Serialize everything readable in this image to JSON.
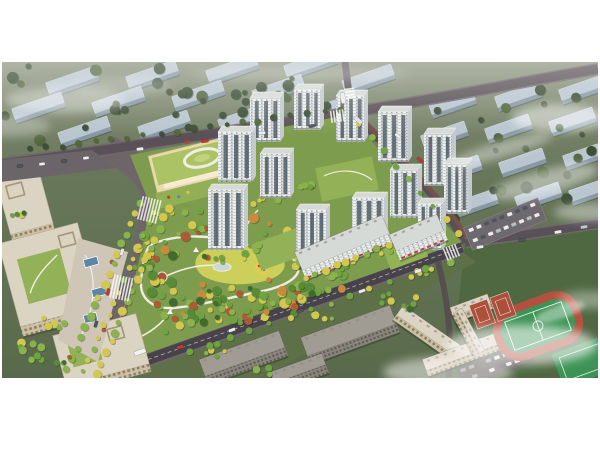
{
  "meta": {
    "type": "architectural-aerial-rendering",
    "description": "Bird's-eye rendering of a residential masterplan: white high-rise towers around a large landscaped central park, a kindergarten with a light-green roof and oval rooftop track, beige office blocks on a tree-lined boulevard to the west, ground-floor retail slabs with red awnings along the south street, a school campus with red basketball courts and a green running-track field to the south-east, and hazy rows of blue-grey apartment slabs with drifting mist in the background. No text appears in the image.",
    "canvas": {
      "width": 600,
      "height": 450
    },
    "frame_color": "#ffffff"
  },
  "palette": {
    "frame": "#ffffff",
    "hazeTop": "#8a927c",
    "bgMid": "#68775a",
    "bgDark": "#596a4b",
    "woodDark": "#4f6842",
    "southGreen": "#5d7048",
    "bgTree1": "#3d4f35",
    "bgTree2": "#54673f",
    "slabTop": "#b9c6d0",
    "slabSide": "#8798a4",
    "road": "#595157",
    "roadCasing": "#6f676b",
    "roadDark": "#48434a",
    "avenue": "#6f6569",
    "sidewalkRed": "#7c5148",
    "pavement": "#cfc6b8",
    "siteGround": "#7e9c4d",
    "courtyard": "#93b156",
    "lawn": "#ccd05a",
    "path": "#efece1",
    "parkG1": "#3f6b2e",
    "parkG2": "#578b38",
    "parkG3": "#6fa341",
    "parkG4": "#8ab24d",
    "autumnY": "#d3c84f",
    "autumnO": "#c98a3e",
    "autumnR": "#ad5a35",
    "towerFace": "#edefee",
    "towerSide": "#c3c9cc",
    "towerRoof": "#d6dad6",
    "towerWin": "#46525c",
    "floorLine": "#9aa1a6",
    "awning": "#b2483c",
    "grayFace": "#8a867d",
    "grayRoof": "#a09c93",
    "grayWin": "#4e4a45",
    "beigeFace": "#cdbfa2",
    "beigeShade": "#a59577",
    "beigeRoof": "#dcd4c2",
    "beigeWin": "#6e6355",
    "kgRoof": "#abc364",
    "kgWall": "#e8dba9",
    "fieldGreen": "#3d9355",
    "trackRed": "#b2513f",
    "courtRed": "#ae4f3c",
    "canopyBlue": "#5c86a8",
    "water": "#c7d9d2",
    "flowerBed": "#a9553e",
    "playYellow": "#e2cb53",
    "carWhite": "#ececec",
    "carDark": "#4e555c",
    "carRed": "#c03b30",
    "mist": "#ffffff"
  },
  "scene": {
    "regions": [
      {
        "name": "background-city-left",
        "desc": "hazy rows of blue-grey apartment slabs among dark trees, upper left"
      },
      {
        "name": "background-city-right",
        "desc": "grid of blue-grey apartment slabs with mist, upper right"
      },
      {
        "name": "road-network",
        "desc": "top boulevard, west tree-lined avenue, south retail street, east access road"
      },
      {
        "name": "residential-site",
        "desc": "main parcel with towers, park and kindergarten"
      },
      {
        "name": "central-park",
        "desc": "dense trees, yellow lawn, winding white paths, pond, playground, flower beds"
      },
      {
        "name": "kindergarten",
        "desc": "green-roofed kindergarten with white oval rooftop track"
      },
      {
        "name": "tower-cluster",
        "desc": "thirteen white residential high-rises with dark window strips"
      },
      {
        "name": "retail-slabs",
        "desc": "white mid-rise slabs with red shop awnings along south street"
      },
      {
        "name": "south-blocks",
        "desc": "grey mid-rise slabs south of the retail street"
      },
      {
        "name": "school-campus",
        "desc": "beige school buildings, basketball courts, parking"
      },
      {
        "name": "sports-field",
        "desc": "green pitch inside a red running track, second court at the corner"
      },
      {
        "name": "office-complex",
        "desc": "beige office blocks with roof courtyards and plaza with blue canopies"
      },
      {
        "name": "mist-clouds",
        "desc": "soft white mist drifting across background and lower right"
      }
    ]
  }
}
